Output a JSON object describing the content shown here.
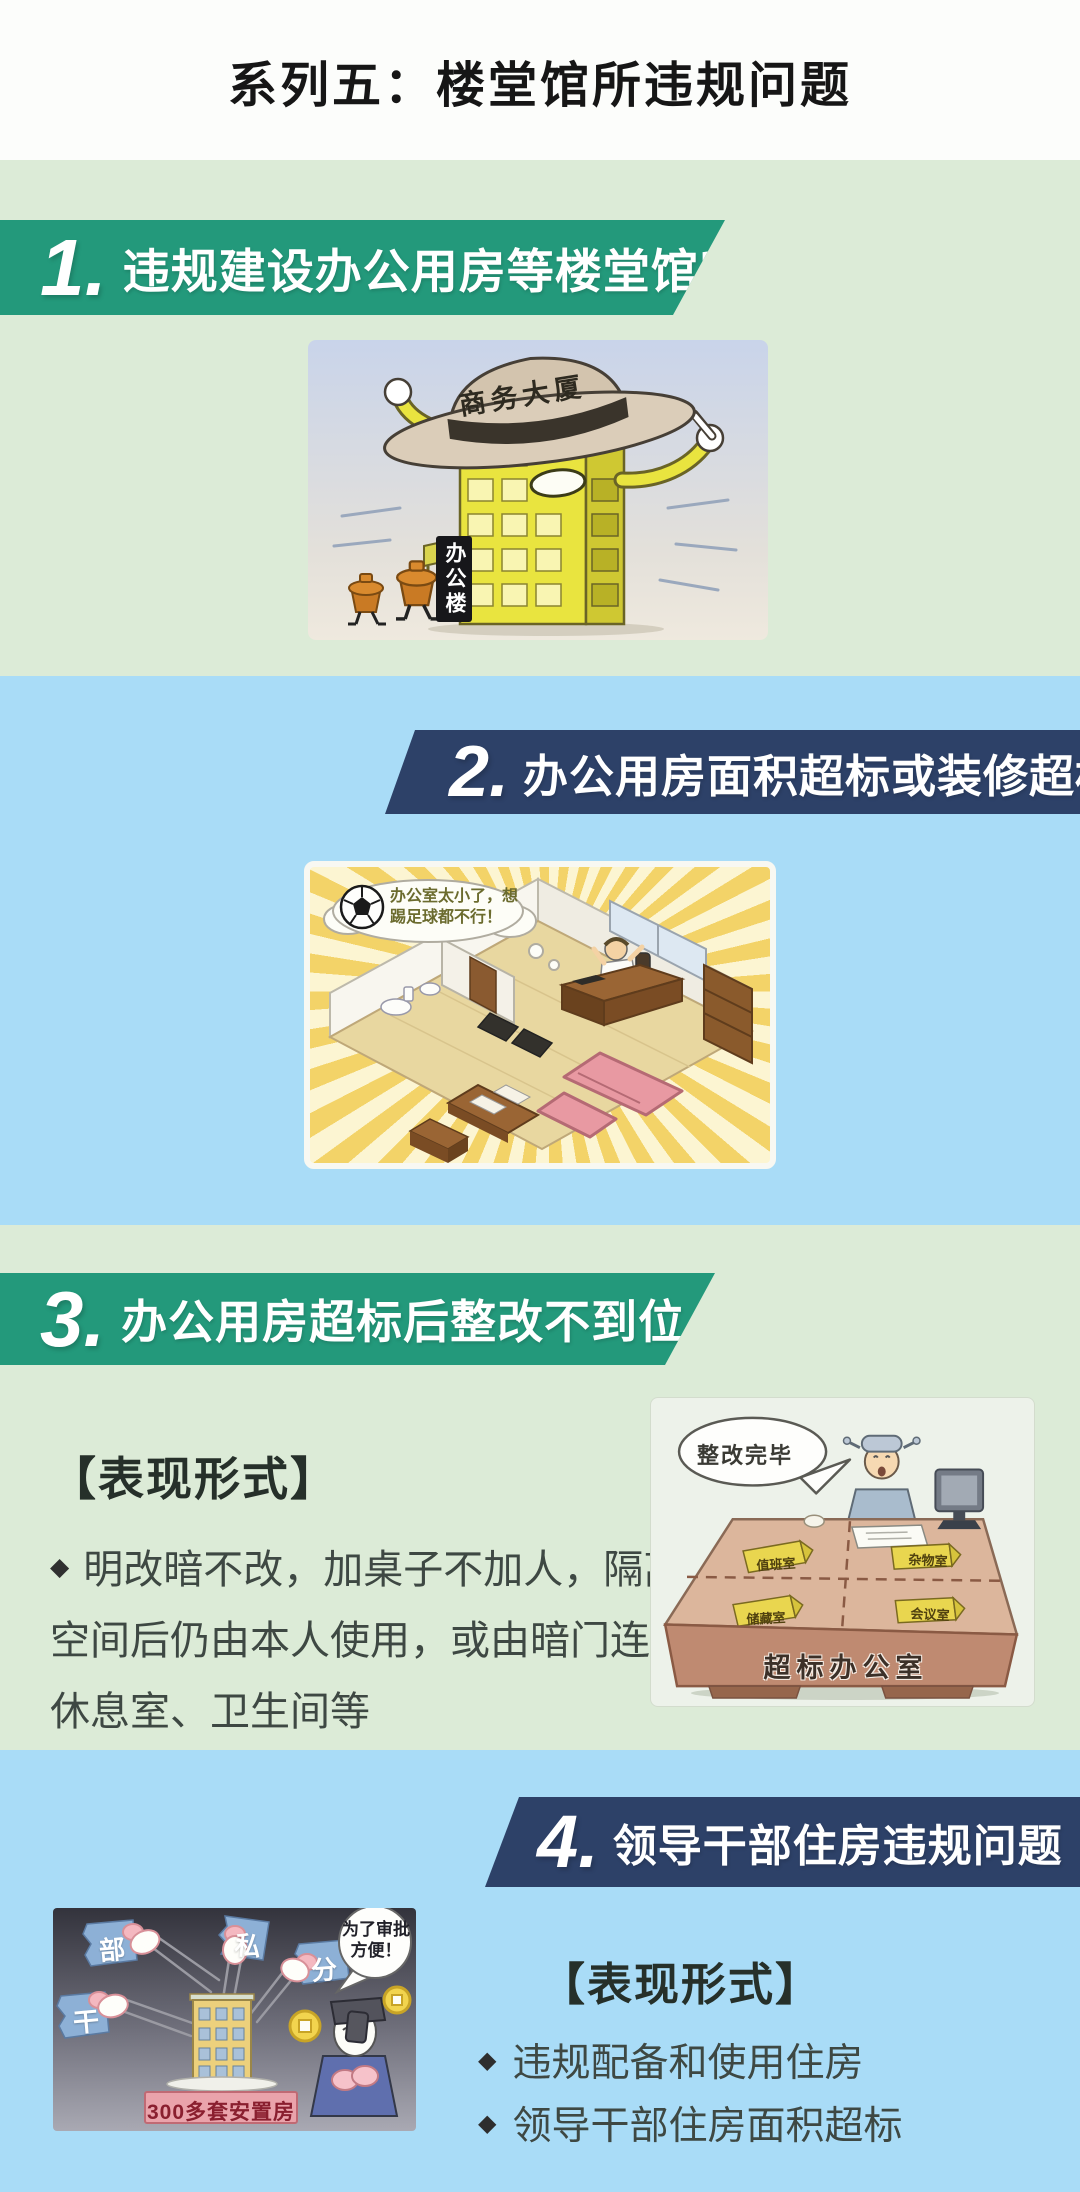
{
  "header": {
    "title": "系列五：楼堂馆所违规问题"
  },
  "bullet_marker": "◆",
  "sections": [
    {
      "number": "1.",
      "title": "违规建设办公用房等楼堂馆所",
      "illustration": {
        "hat_label": "商务大厦",
        "building_sign": "办公楼"
      }
    },
    {
      "number": "2.",
      "title": "办公用房面积超标或装修超标",
      "illustration": {
        "thought_text": "办公室太小了，想踢足球都不行！"
      }
    },
    {
      "number": "3.",
      "title": "办公用房超标后整改不到位",
      "heading": "【表现形式】",
      "bullets": [
        "明改暗不改，加桌子不加人，隔离空间后仍由本人使用，或由暗门连接休息室、卫生间等"
      ],
      "illustration": {
        "speech": "整改完毕",
        "signs": [
          "值班室",
          "杂物室",
          "储藏室",
          "会议室"
        ],
        "desk_label": "超标办公室"
      }
    },
    {
      "number": "4.",
      "title": "领导干部住房违规问题",
      "heading": "【表现形式】",
      "bullets": [
        "违规配备和使用住房",
        "领导干部住房面积超标"
      ],
      "illustration": {
        "flags": [
          "部",
          "干",
          "私",
          "分"
        ],
        "house_sign": "300多套安置房",
        "speech": "为了审批方便！"
      }
    }
  ],
  "colors": {
    "green_banner": "#23997b",
    "navy_banner": "#2d4168",
    "green_section_bg": "#dcebd7",
    "blue_section_bg": "#a9dcf7",
    "header_bg": "#fcfdfb"
  }
}
